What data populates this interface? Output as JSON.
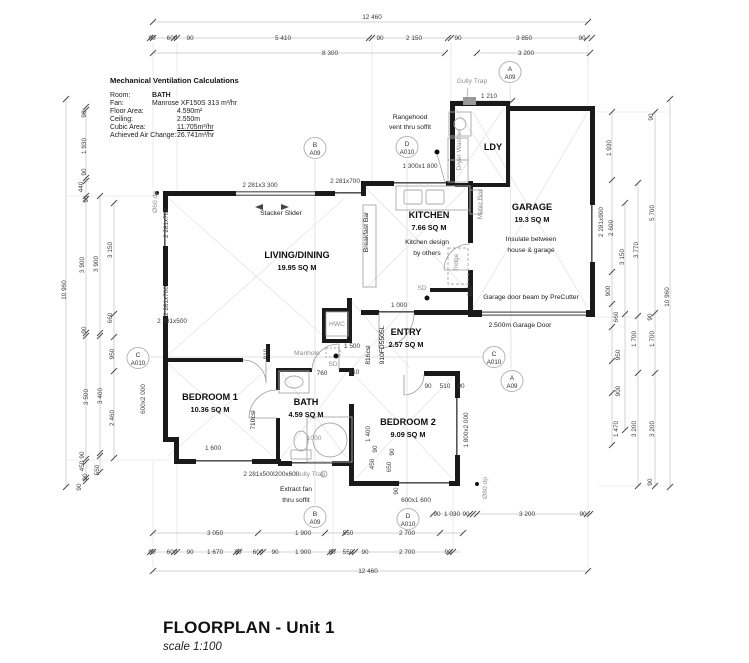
{
  "colors": {
    "wall": "#1a1a1a",
    "window_line": "#555555",
    "dim_line": "#c4c4c4",
    "tick": "#4a4a4a",
    "grey_text": "#8f8f8f",
    "text": "#1c1c1c",
    "fixture": "#a8a8a8",
    "diagonal": "#e4e4e4",
    "section_line": "#d0d0d0",
    "paper": "#ffffff"
  },
  "vent_calc": {
    "title": "Mechanical Ventilation Calculations",
    "rows": [
      {
        "label": "Room:",
        "value": "BATH",
        "indent": 42,
        "bold": true,
        "underline": false
      },
      {
        "label": "Fan:",
        "value": "Manrose XF150S 313 m³/hr",
        "indent": 42,
        "bold": false,
        "underline": false
      },
      {
        "label": "Floor Area:",
        "value": "4.590m²",
        "indent": 67,
        "bold": false,
        "underline": false
      },
      {
        "label": "Ceiling:",
        "value": "2.550m",
        "indent": 67,
        "bold": false,
        "underline": false
      },
      {
        "label": "Cubic Area:",
        "value": "11.705m³/hr",
        "indent": 67,
        "bold": false,
        "underline": true
      },
      {
        "label": "Achieved Air Change:",
        "value": "26.741m³/hr",
        "indent": 67,
        "bold": false,
        "underline": false
      }
    ]
  },
  "rooms": [
    {
      "name": "LIVING/DINING",
      "area": "19.95 SQ M",
      "x": 297,
      "y": 258
    },
    {
      "name": "KITCHEN",
      "area": "7.66 SQ M",
      "x": 429,
      "y": 218
    },
    {
      "name": "GARAGE",
      "area": "19.3 SQ M",
      "x": 532,
      "y": 210
    },
    {
      "name": "LDY",
      "area": "",
      "x": 493,
      "y": 150
    },
    {
      "name": "ENTRY",
      "area": "2.57 SQ M",
      "x": 406,
      "y": 335
    },
    {
      "name": "BEDROOM 1",
      "area": "10.36 SQ M",
      "x": 210,
      "y": 400
    },
    {
      "name": "BATH",
      "area": "4.59 SQ M",
      "x": 306,
      "y": 405
    },
    {
      "name": "BEDROOM 2",
      "area": "9.09 SQ M",
      "x": 408,
      "y": 425
    }
  ],
  "plan_labels": [
    {
      "t": "Gully Trap",
      "x": 472,
      "y": 83,
      "g": 1
    },
    {
      "t": "Stacker Slider",
      "x": 281,
      "y": 215
    },
    {
      "t": "Rangehood",
      "x": 410,
      "y": 119
    },
    {
      "t": "vent thru soffit",
      "x": 410,
      "y": 129
    },
    {
      "t": "Kitchen design",
      "x": 427,
      "y": 244
    },
    {
      "t": "by others",
      "x": 427,
      "y": 255
    },
    {
      "t": "Insulate between",
      "x": 531,
      "y": 241
    },
    {
      "t": "house & garage",
      "x": 531,
      "y": 252
    },
    {
      "t": "Garage door beam by PreCutter",
      "x": 531,
      "y": 299
    },
    {
      "t": "2.500m Garage Door",
      "x": 520,
      "y": 327
    },
    {
      "t": "Breakfast Bar",
      "x": 368,
      "y": 232,
      "r": -90
    },
    {
      "t": "Meter Box",
      "x": 482,
      "y": 204,
      "r": -90,
      "g": 1
    },
    {
      "t": "Dryer    Washer",
      "x": 461,
      "y": 150,
      "r": -90,
      "g": 1
    },
    {
      "t": "fridge",
      "x": 458,
      "y": 262,
      "r": -90,
      "g": 1
    },
    {
      "t": "SD",
      "x": 422,
      "y": 290,
      "g": 1
    },
    {
      "t": "SD",
      "x": 333,
      "y": 366,
      "g": 1
    },
    {
      "t": "HWC",
      "x": 337,
      "y": 326,
      "g": 1
    },
    {
      "t": "Manhole",
      "x": 307,
      "y": 355,
      "g": 1
    },
    {
      "t": "1000",
      "x": 314,
      "y": 440,
      "g": 1
    },
    {
      "t": "Gully Trap",
      "x": 310,
      "y": 476,
      "g": 1
    },
    {
      "t": "Extract fan",
      "x": 296,
      "y": 491
    },
    {
      "t": "thru soffit",
      "x": 296,
      "y": 502
    },
    {
      "t": "Ø60 dp",
      "x": 157,
      "y": 202,
      "r": -90,
      "g": 1
    },
    {
      "t": "Ø80 dp",
      "x": 487,
      "y": 488,
      "r": -90,
      "g": 1
    },
    {
      "t": "910FD5505L",
      "x": 384,
      "y": 345,
      "r": -90
    },
    {
      "t": "816csl",
      "x": 370,
      "y": 355,
      "r": -90
    },
    {
      "t": "710csl",
      "x": 255,
      "y": 420,
      "r": -90
    }
  ],
  "window_labels": [
    {
      "t": "2 281x3 300",
      "x": 260,
      "y": 187
    },
    {
      "t": "2 281x700",
      "x": 345,
      "y": 183
    },
    {
      "t": "2 281x700",
      "x": 168,
      "y": 223,
      "r": -90
    },
    {
      "t": "2 281x700",
      "x": 168,
      "y": 301,
      "r": -90
    },
    {
      "t": "2 281x500",
      "x": 172,
      "y": 323
    },
    {
      "t": "600x2 000",
      "x": 145,
      "y": 399,
      "r": -90
    },
    {
      "t": "1 300x1 800",
      "x": 420,
      "y": 168
    },
    {
      "t": "2 281x900",
      "x": 603,
      "y": 222,
      "r": -90
    },
    {
      "t": "1 800x2 000",
      "x": 468,
      "y": 430,
      "r": -90
    },
    {
      "t": "600x1 600",
      "x": 416,
      "y": 502
    },
    {
      "t": "2 281x500l",
      "x": 259,
      "y": 476
    },
    {
      "t": "200x600",
      "x": 287,
      "y": 476
    }
  ],
  "dim_labels": [
    {
      "t": "12 460",
      "x": 372,
      "y": 19
    },
    {
      "t": "90",
      "x": 152,
      "y": 40
    },
    {
      "t": "600",
      "x": 172,
      "y": 40
    },
    {
      "t": "90",
      "x": 190,
      "y": 40
    },
    {
      "t": "5 410",
      "x": 283,
      "y": 40
    },
    {
      "t": "90",
      "x": 380,
      "y": 40
    },
    {
      "t": "2 150",
      "x": 414,
      "y": 40
    },
    {
      "t": "90",
      "x": 458,
      "y": 40
    },
    {
      "t": "3 850",
      "x": 524,
      "y": 40
    },
    {
      "t": "90",
      "x": 582,
      "y": 40
    },
    {
      "t": "8 300",
      "x": 330,
      "y": 55
    },
    {
      "t": "3 200",
      "x": 526,
      "y": 55
    },
    {
      "t": "1 210",
      "x": 489,
      "y": 98
    },
    {
      "t": "1 000",
      "x": 399,
      "y": 307
    },
    {
      "t": "1 500",
      "x": 352,
      "y": 348
    },
    {
      "t": "760",
      "x": 322,
      "y": 375
    },
    {
      "t": "810",
      "x": 354,
      "y": 374
    },
    {
      "t": "810",
      "x": 268,
      "y": 354,
      "r": -90
    },
    {
      "t": "810",
      "x": 472,
      "y": 291,
      "r": -90
    },
    {
      "t": "90",
      "x": 428,
      "y": 388
    },
    {
      "t": "510",
      "x": 445,
      "y": 388
    },
    {
      "t": "90",
      "x": 461,
      "y": 388
    },
    {
      "t": "1 600",
      "x": 213,
      "y": 450
    },
    {
      "t": "1 400",
      "x": 370,
      "y": 434,
      "r": -90
    },
    {
      "t": "450",
      "x": 374,
      "y": 464,
      "r": -90
    },
    {
      "t": "90",
      "x": 377,
      "y": 449,
      "r": -90
    },
    {
      "t": "650",
      "x": 391,
      "y": 467,
      "r": -90
    },
    {
      "t": "90",
      "x": 394,
      "y": 452,
      "r": -90
    },
    {
      "t": "90",
      "x": 398,
      "y": 491,
      "r": -90
    },
    {
      "t": "90",
      "x": 437,
      "y": 516
    },
    {
      "t": "1 030",
      "x": 452,
      "y": 516
    },
    {
      "t": "90",
      "x": 466,
      "y": 516
    },
    {
      "t": "3 200",
      "x": 527,
      "y": 516
    },
    {
      "t": "90",
      "x": 583,
      "y": 516
    },
    {
      "t": "3 050",
      "x": 215,
      "y": 535
    },
    {
      "t": "1 900",
      "x": 303,
      "y": 535
    },
    {
      "t": "550",
      "x": 348,
      "y": 535
    },
    {
      "t": "2 700",
      "x": 407,
      "y": 535
    },
    {
      "t": "90",
      "x": 152,
      "y": 554
    },
    {
      "t": "600",
      "x": 172,
      "y": 554
    },
    {
      "t": "90",
      "x": 190,
      "y": 554
    },
    {
      "t": "1 670",
      "x": 215,
      "y": 554
    },
    {
      "t": "90",
      "x": 238,
      "y": 554
    },
    {
      "t": "600",
      "x": 258,
      "y": 554
    },
    {
      "t": "90",
      "x": 275,
      "y": 554
    },
    {
      "t": "1 900",
      "x": 303,
      "y": 554
    },
    {
      "t": "90",
      "x": 332,
      "y": 554
    },
    {
      "t": "550",
      "x": 348,
      "y": 554
    },
    {
      "t": "90",
      "x": 365,
      "y": 554
    },
    {
      "t": "2 700",
      "x": 407,
      "y": 554
    },
    {
      "t": "90",
      "x": 448,
      "y": 554
    },
    {
      "t": "12 460",
      "x": 368,
      "y": 573
    },
    {
      "t": "10 960",
      "x": 66,
      "y": 290,
      "r": -90
    },
    {
      "t": "90",
      "x": 86,
      "y": 114,
      "r": -90
    },
    {
      "t": "1 930",
      "x": 86,
      "y": 146,
      "r": -90
    },
    {
      "t": "90",
      "x": 86,
      "y": 172,
      "r": -90
    },
    {
      "t": "440",
      "x": 83,
      "y": 187,
      "r": -90
    },
    {
      "t": "90",
      "x": 88,
      "y": 199,
      "r": -90
    },
    {
      "t": "3 900",
      "x": 84,
      "y": 265,
      "r": -90
    },
    {
      "t": "3 900",
      "x": 98,
      "y": 264,
      "r": -90
    },
    {
      "t": "3 150",
      "x": 112,
      "y": 250,
      "r": -90
    },
    {
      "t": "90",
      "x": 86,
      "y": 330,
      "r": -90
    },
    {
      "t": "660",
      "x": 112,
      "y": 318,
      "r": -90
    },
    {
      "t": "950",
      "x": 114,
      "y": 354,
      "r": -90
    },
    {
      "t": "3 500",
      "x": 88,
      "y": 397,
      "r": -90
    },
    {
      "t": "3 400",
      "x": 102,
      "y": 396,
      "r": -90
    },
    {
      "t": "2 460",
      "x": 114,
      "y": 418,
      "r": -90
    },
    {
      "t": "90",
      "x": 84,
      "y": 455,
      "r": -90
    },
    {
      "t": "450",
      "x": 84,
      "y": 466,
      "r": -90
    },
    {
      "t": "90",
      "x": 87,
      "y": 477,
      "r": -90
    },
    {
      "t": "550",
      "x": 99,
      "y": 470,
      "r": -90
    },
    {
      "t": "90",
      "x": 81,
      "y": 487,
      "r": -90
    },
    {
      "t": "90",
      "x": 653,
      "y": 117,
      "r": -90
    },
    {
      "t": "1 930",
      "x": 611,
      "y": 148,
      "r": -90
    },
    {
      "t": "2 600",
      "x": 613,
      "y": 228,
      "r": -90
    },
    {
      "t": "900",
      "x": 610,
      "y": 291,
      "r": -90
    },
    {
      "t": "660",
      "x": 618,
      "y": 317,
      "r": -90
    },
    {
      "t": "950",
      "x": 620,
      "y": 355,
      "r": -90
    },
    {
      "t": "900",
      "x": 620,
      "y": 391,
      "r": -90
    },
    {
      "t": "1 470",
      "x": 618,
      "y": 429,
      "r": -90
    },
    {
      "t": "3 150",
      "x": 624,
      "y": 257,
      "r": -90
    },
    {
      "t": "3 770",
      "x": 638,
      "y": 250,
      "r": -90
    },
    {
      "t": "5 700",
      "x": 654,
      "y": 213,
      "r": -90
    },
    {
      "t": "1 700",
      "x": 636,
      "y": 339,
      "r": -90
    },
    {
      "t": "1 700",
      "x": 654,
      "y": 339,
      "r": -90
    },
    {
      "t": "3 200",
      "x": 636,
      "y": 429,
      "r": -90
    },
    {
      "t": "3 200",
      "x": 654,
      "y": 429,
      "r": -90
    },
    {
      "t": "90",
      "x": 652,
      "y": 317,
      "r": -90
    },
    {
      "t": "90",
      "x": 652,
      "y": 482,
      "r": -90
    },
    {
      "t": "10 960",
      "x": 669,
      "y": 297,
      "r": -90
    }
  ],
  "markers": [
    {
      "letter": "B",
      "sheet": "A09",
      "x": 315,
      "y": 148
    },
    {
      "letter": "D",
      "sheet": "A010",
      "x": 407,
      "y": 147
    },
    {
      "letter": "A",
      "sheet": "A09",
      "x": 510,
      "y": 72
    },
    {
      "letter": "C",
      "sheet": "A010",
      "x": 138,
      "y": 358
    },
    {
      "letter": "C",
      "sheet": "A010",
      "x": 494,
      "y": 357
    },
    {
      "letter": "A",
      "sheet": "A09",
      "x": 512,
      "y": 381
    },
    {
      "letter": "B",
      "sheet": "A09",
      "x": 315,
      "y": 517
    },
    {
      "letter": "D",
      "sheet": "A010",
      "x": 408,
      "y": 519
    }
  ],
  "title_block": {
    "title": "FLOORPLAN - Unit 1",
    "scale": "scale 1:100"
  }
}
